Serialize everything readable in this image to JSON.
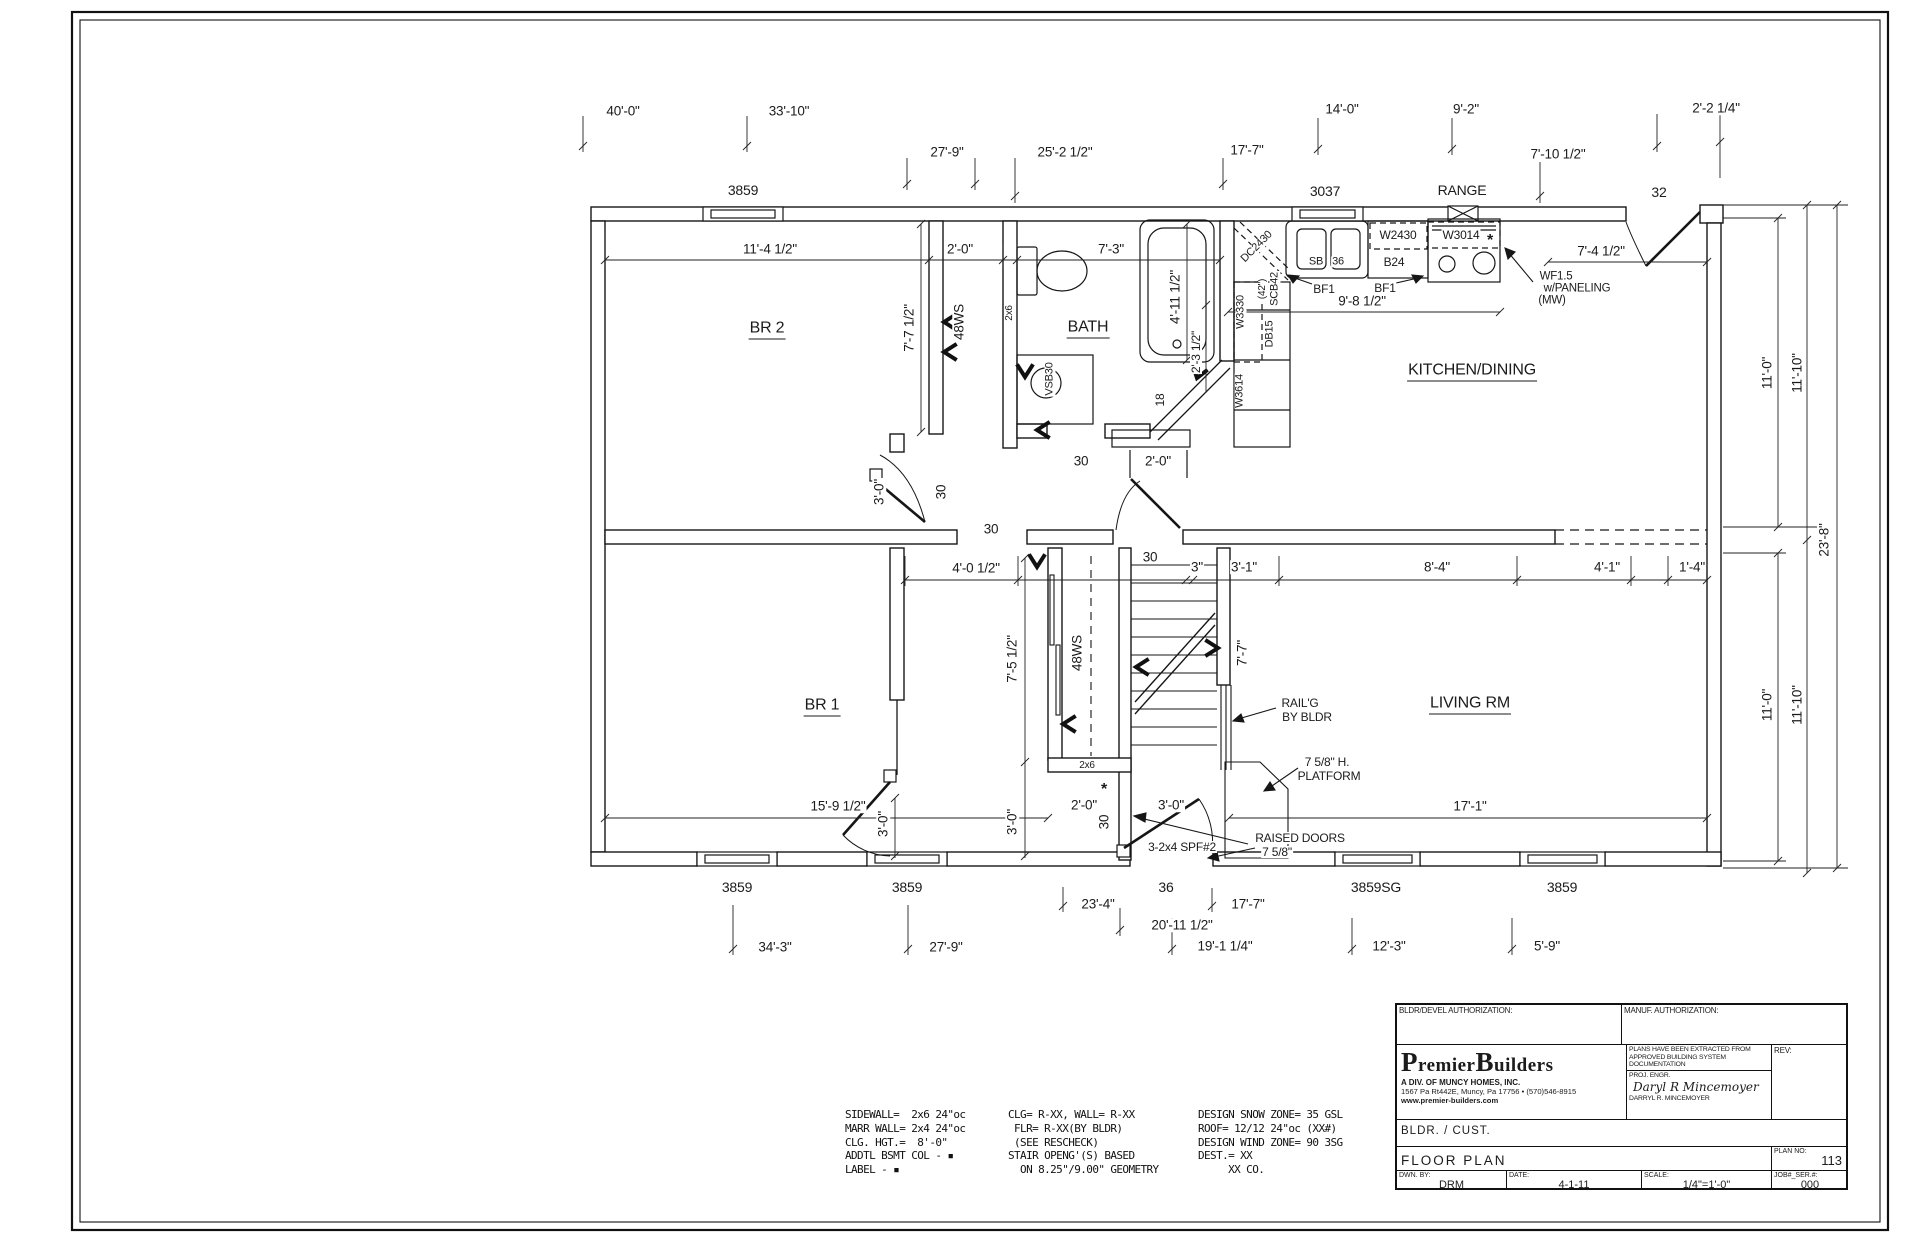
{
  "sheet": {
    "kind": "architectural floor plan drawing"
  },
  "labels": [
    {
      "t": "40'-0\"",
      "x": 623,
      "y": 111
    },
    {
      "t": "33'-10\"",
      "x": 789,
      "y": 111
    },
    {
      "t": "14'-0\"",
      "x": 1342,
      "y": 109
    },
    {
      "t": "9'-2\"",
      "x": 1466,
      "y": 109
    },
    {
      "t": "2'-2 1/4\"",
      "x": 1716,
      "y": 108
    },
    {
      "t": "27'-9\"",
      "x": 947,
      "y": 152
    },
    {
      "t": "25'-2 1/2\"",
      "x": 1065,
      "y": 152
    },
    {
      "t": "17'-7\"",
      "x": 1247,
      "y": 150
    },
    {
      "t": "7'-10 1/2\"",
      "x": 1558,
      "y": 154
    },
    {
      "t": "3859",
      "x": 743,
      "y": 190,
      "k": "win"
    },
    {
      "t": "3037",
      "x": 1325,
      "y": 191,
      "k": "win"
    },
    {
      "t": "RANGE",
      "x": 1462,
      "y": 190,
      "k": "win"
    },
    {
      "t": "32",
      "x": 1659,
      "y": 192,
      "k": "win"
    },
    {
      "t": "11'-4 1/2\"",
      "x": 770,
      "y": 249
    },
    {
      "t": "2'-0\"",
      "x": 960,
      "y": 249
    },
    {
      "t": "7'-3\"",
      "x": 1111,
      "y": 249
    },
    {
      "t": "7'-4 1/2\"",
      "x": 1601,
      "y": 251
    },
    {
      "t": "7'-7 1/2\"",
      "x": 909,
      "y": 328,
      "r": -90
    },
    {
      "t": "48WS",
      "x": 959,
      "y": 322,
      "r": -90
    },
    {
      "t": "2x6",
      "x": 1010,
      "y": 313,
      "r": -90,
      "s": 10
    },
    {
      "t": "4'-11 1/2\"",
      "x": 1175,
      "y": 297,
      "r": -90
    },
    {
      "t": "W3330",
      "x": 1241,
      "y": 312,
      "r": -90,
      "k": "cab"
    },
    {
      "t": "(42\")",
      "x": 1263,
      "y": 289,
      "r": -90,
      "k": "cab",
      "s": 10
    },
    {
      "t": "SCB42",
      "x": 1275,
      "y": 289,
      "r": -90,
      "k": "cab"
    },
    {
      "t": "DB15",
      "x": 1270,
      "y": 334,
      "r": -90,
      "k": "cab"
    },
    {
      "t": "W3614",
      "x": 1240,
      "y": 391,
      "r": -90,
      "k": "cab"
    },
    {
      "t": "VSB30",
      "x": 1050,
      "y": 379,
      "r": -90,
      "k": "cab"
    },
    {
      "t": "DC2430",
      "x": 1257,
      "y": 247,
      "r": -45,
      "k": "cab"
    },
    {
      "t": "2'-3 1/2\"",
      "x": 1196,
      "y": 352,
      "r": -90,
      "s": 12
    },
    {
      "t": "18",
      "x": 1160,
      "y": 400,
      "r": -90,
      "s": 12
    },
    {
      "t": "SB",
      "x": 1316,
      "y": 262,
      "k": "cab"
    },
    {
      "t": "36",
      "x": 1338,
      "y": 262,
      "k": "cab"
    },
    {
      "t": "W2430",
      "x": 1398,
      "y": 235,
      "k": "cab",
      "s": 12
    },
    {
      "t": "B24",
      "x": 1394,
      "y": 262,
      "k": "cab",
      "s": 12
    },
    {
      "t": "W3014",
      "x": 1461,
      "y": 235,
      "k": "cab",
      "s": 12
    },
    {
      "t": "*",
      "x": 1490,
      "y": 241,
      "k": "star"
    },
    {
      "t": "BF1",
      "x": 1324,
      "y": 289,
      "s": 12
    },
    {
      "t": "BF1",
      "x": 1385,
      "y": 288,
      "s": 12
    },
    {
      "t": "9'-8 1/2\"",
      "x": 1362,
      "y": 301
    },
    {
      "t": "WF1.5",
      "x": 1556,
      "y": 277,
      "k": "note"
    },
    {
      "t": "w/PANELING",
      "x": 1577,
      "y": 289,
      "k": "note"
    },
    {
      "t": "(MW)",
      "x": 1552,
      "y": 301,
      "k": "note"
    },
    {
      "t": "30",
      "x": 1081,
      "y": 461
    },
    {
      "t": "2'-0\"",
      "x": 1158,
      "y": 461
    },
    {
      "t": "30",
      "x": 941,
      "y": 492,
      "r": -90
    },
    {
      "t": "3'-0\"",
      "x": 879,
      "y": 492,
      "r": -90
    },
    {
      "t": "30",
      "x": 991,
      "y": 529
    },
    {
      "t": "30",
      "x": 1150,
      "y": 557
    },
    {
      "t": "4'-0 1/2\"",
      "x": 976,
      "y": 568
    },
    {
      "t": "3\"",
      "x": 1197,
      "y": 567
    },
    {
      "t": "3'-1\"",
      "x": 1244,
      "y": 567
    },
    {
      "t": "8'-4\"",
      "x": 1437,
      "y": 567
    },
    {
      "t": "4'-1\"",
      "x": 1607,
      "y": 567
    },
    {
      "t": "1'-4\"",
      "x": 1692,
      "y": 567
    },
    {
      "t": "11'-0\"",
      "x": 1767,
      "y": 373,
      "r": -90
    },
    {
      "t": "11'-10\"",
      "x": 1797,
      "y": 373,
      "r": -90
    },
    {
      "t": "11'-0\"",
      "x": 1767,
      "y": 705,
      "r": -90
    },
    {
      "t": "11'-10\"",
      "x": 1797,
      "y": 705,
      "r": -90
    },
    {
      "t": "23'-8\"",
      "x": 1824,
      "y": 540,
      "r": -90
    },
    {
      "t": "BR 2",
      "x": 767,
      "y": 330,
      "k": "room"
    },
    {
      "t": "BATH",
      "x": 1088,
      "y": 329,
      "k": "room"
    },
    {
      "t": "KITCHEN/DINING",
      "x": 1472,
      "y": 372,
      "k": "room"
    },
    {
      "t": "BR 1",
      "x": 822,
      "y": 707,
      "k": "room"
    },
    {
      "t": "LIVING RM",
      "x": 1470,
      "y": 705,
      "k": "room"
    },
    {
      "t": "7'-5 1/2\"",
      "x": 1012,
      "y": 659,
      "r": -90
    },
    {
      "t": "48WS",
      "x": 1077,
      "y": 653,
      "r": -90
    },
    {
      "t": "7'-7\"",
      "x": 1242,
      "y": 653,
      "r": -90
    },
    {
      "t": "2x6",
      "x": 1087,
      "y": 766,
      "s": 10
    },
    {
      "t": "RAIL'G",
      "x": 1300,
      "y": 703,
      "s": 12
    },
    {
      "t": "BY BLDR",
      "x": 1307,
      "y": 717,
      "s": 12
    },
    {
      "t": "7 5/8\" H.",
      "x": 1327,
      "y": 762,
      "s": 12
    },
    {
      "t": "PLATFORM",
      "x": 1329,
      "y": 776,
      "s": 12
    },
    {
      "t": "RAISED DOORS",
      "x": 1300,
      "y": 838,
      "s": 12
    },
    {
      "t": "7 5/8\"",
      "x": 1277,
      "y": 852,
      "s": 12
    },
    {
      "t": "3-2x4 SPF#2",
      "x": 1182,
      "y": 847,
      "s": 12
    },
    {
      "t": "*",
      "x": 1104,
      "y": 790,
      "k": "star"
    },
    {
      "t": "30",
      "x": 1104,
      "y": 822,
      "r": -90
    },
    {
      "t": "2'-0\"",
      "x": 1084,
      "y": 805
    },
    {
      "t": "3'-0\"",
      "x": 1171,
      "y": 805
    },
    {
      "t": "3'-0\"",
      "x": 1012,
      "y": 822,
      "r": -90
    },
    {
      "t": "3'-0\"",
      "x": 883,
      "y": 824,
      "r": -90
    },
    {
      "t": "15'-9 1/2\"",
      "x": 838,
      "y": 806
    },
    {
      "t": "17'-1\"",
      "x": 1470,
      "y": 806
    },
    {
      "t": "3859",
      "x": 737,
      "y": 887,
      "k": "win"
    },
    {
      "t": "3859",
      "x": 907,
      "y": 887,
      "k": "win"
    },
    {
      "t": "36",
      "x": 1166,
      "y": 887,
      "k": "win"
    },
    {
      "t": "3859SG",
      "x": 1376,
      "y": 887,
      "k": "win"
    },
    {
      "t": "3859",
      "x": 1562,
      "y": 887,
      "k": "win"
    },
    {
      "t": "23'-4\"",
      "x": 1098,
      "y": 904
    },
    {
      "t": "17'-7\"",
      "x": 1248,
      "y": 904
    },
    {
      "t": "20'-11 1/2\"",
      "x": 1182,
      "y": 925
    },
    {
      "t": "19'-1 1/4\"",
      "x": 1225,
      "y": 946
    },
    {
      "t": "34'-3\"",
      "x": 775,
      "y": 947
    },
    {
      "t": "27'-9\"",
      "x": 946,
      "y": 947
    },
    {
      "t": "12'-3\"",
      "x": 1389,
      "y": 946
    },
    {
      "t": "5'-9\"",
      "x": 1547,
      "y": 946
    }
  ],
  "specs": {
    "col1": [
      "SIDEWALL=  2x6 24\"oc",
      "MARR WALL= 2x4 24\"oc",
      "CLG. HGT.=  8'-0\"",
      "ADDTL BSMT COL - ▪",
      "LABEL - ▪"
    ],
    "col2": [
      "CLG= R-XX, WALL= R-XX",
      " FLR= R-XX(BY BLDR)",
      " (SEE RESCHECK)",
      "STAIR OPENG'(S) BASED",
      "  ON 8.25\"/9.00\" GEOMETRY"
    ],
    "col3": [
      "DESIGN SNOW ZONE= 35 GSL",
      "ROOF= 12/12 24\"oc (XX#)",
      "DESIGN WIND ZONE= 90 3SG",
      "DEST.= XX",
      "     XX CO."
    ]
  },
  "title_block": {
    "bldr_auth": "BLDR/DEVEL AUTHORIZATION:",
    "manuf_auth": "MANUF. AUTHORIZATION:",
    "brand_p1": "Premier",
    "brand_p2": "Builders",
    "division": "A DIV. OF MUNCY HOMES, INC.",
    "address": "1567 Pa Rt442E, Muncy, Pa 17756 • (570)546-8915",
    "website": "www.premier-builders.com",
    "plans_note": "PLANS HAVE BEEN EXTRACTED FROM APPROVED BUILDING SYSTEM DOCUMENTATION",
    "proj_engr_label": "PROJ. ENGR.",
    "engineer_sig": "Daryl R Mincemoyer",
    "engineer_name": "DARRYL R. MINCEMOYER",
    "rev_label": "REV:",
    "bldr_cust": "BLDR. / CUST.",
    "sheet_title": "FLOOR PLAN",
    "plan_no_label": "PLAN NO:",
    "plan_no": "113",
    "dwn_label": "DWN. BY:",
    "dwn_by": "DRM",
    "date_label": "DATE:",
    "date": "4-1-11",
    "scale_label": "SCALE:",
    "scale": "1/4\"=1'-0\"",
    "job_label": "JOB#_SER.#:",
    "job": "000"
  }
}
